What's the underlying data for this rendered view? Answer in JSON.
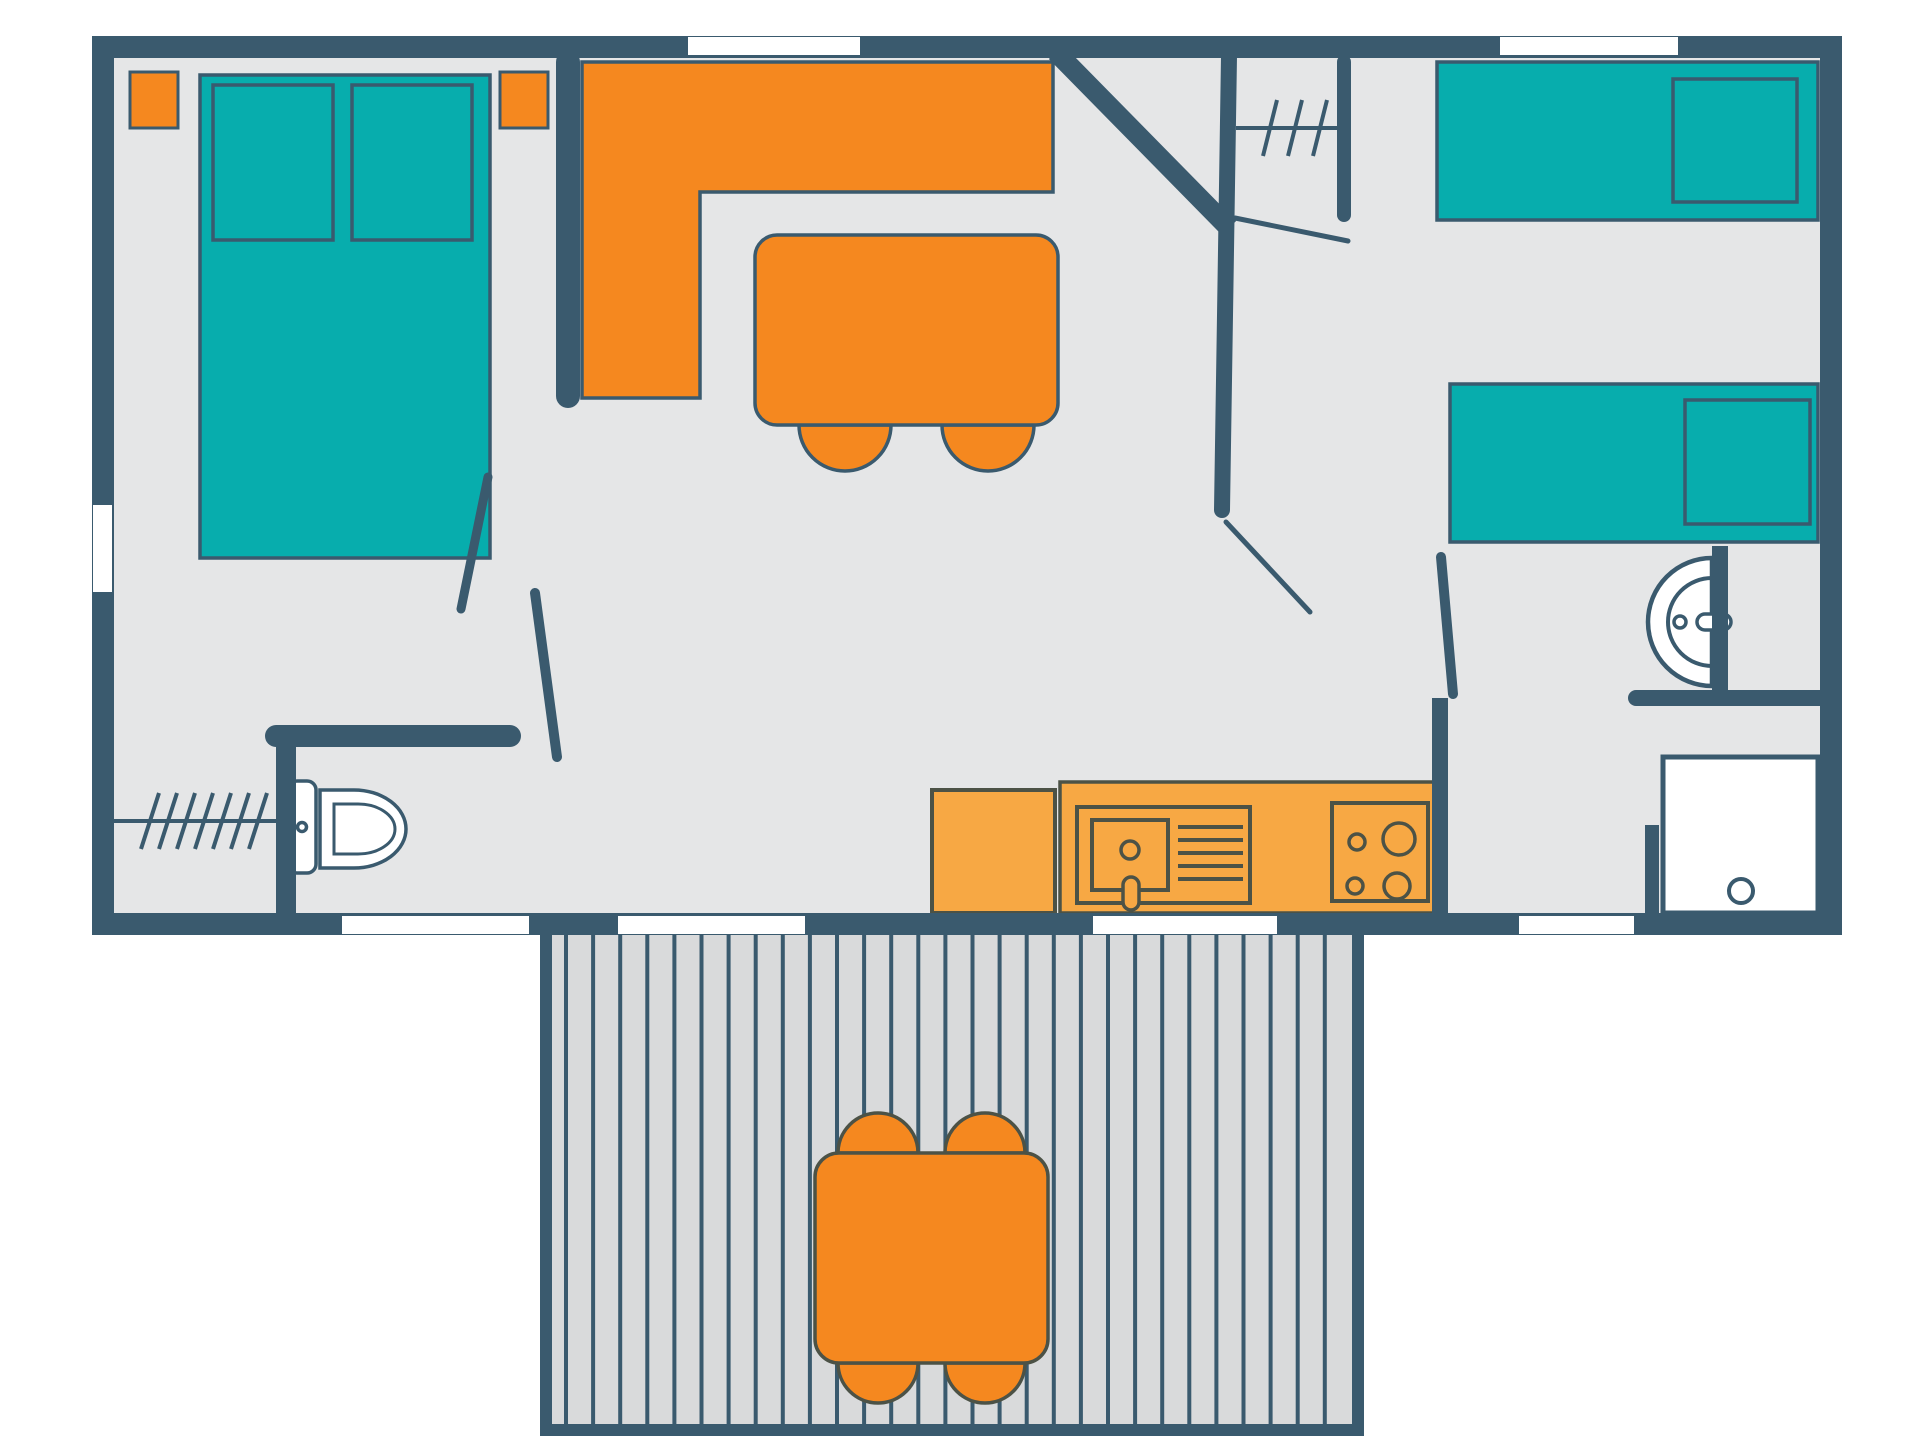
{
  "title": "mobile-home-floor-plan",
  "colors": {
    "page": "#ffffff",
    "wall": "#3a5a6e",
    "floor": "#e5e6e7",
    "teal": "#07adad",
    "orange": "#f5881f",
    "light_orange": "#f7a844",
    "deck": "#d9dadb",
    "white": "#ffffff",
    "detail": "#4c5246"
  },
  "plan": {
    "rooms": [
      "master-bedroom",
      "living-room",
      "hallway",
      "kids-bedroom",
      "bathroom",
      "wc",
      "wardrobe",
      "kitchen",
      "terrace"
    ],
    "furniture_counts": {
      "double_bed": 1,
      "single_bed": 2,
      "pillow": 4,
      "nightstand": 2,
      "l_sofa": 1,
      "dining_table": 1,
      "dining_stool": 2,
      "terrace_table": 1,
      "terrace_stool": 4,
      "toilet": 1,
      "washbasin": 1,
      "shower": 1,
      "kitchen_sink": 1,
      "stove": 1,
      "stove_burner": 4,
      "fridge": 1
    },
    "windows": {
      "top": 2,
      "left": 1,
      "bottom": 4
    },
    "terrace": {
      "plank_count": 29
    },
    "wardrobe": {
      "hatch_count": 7
    },
    "closet": {
      "hatch_count": 3
    }
  }
}
